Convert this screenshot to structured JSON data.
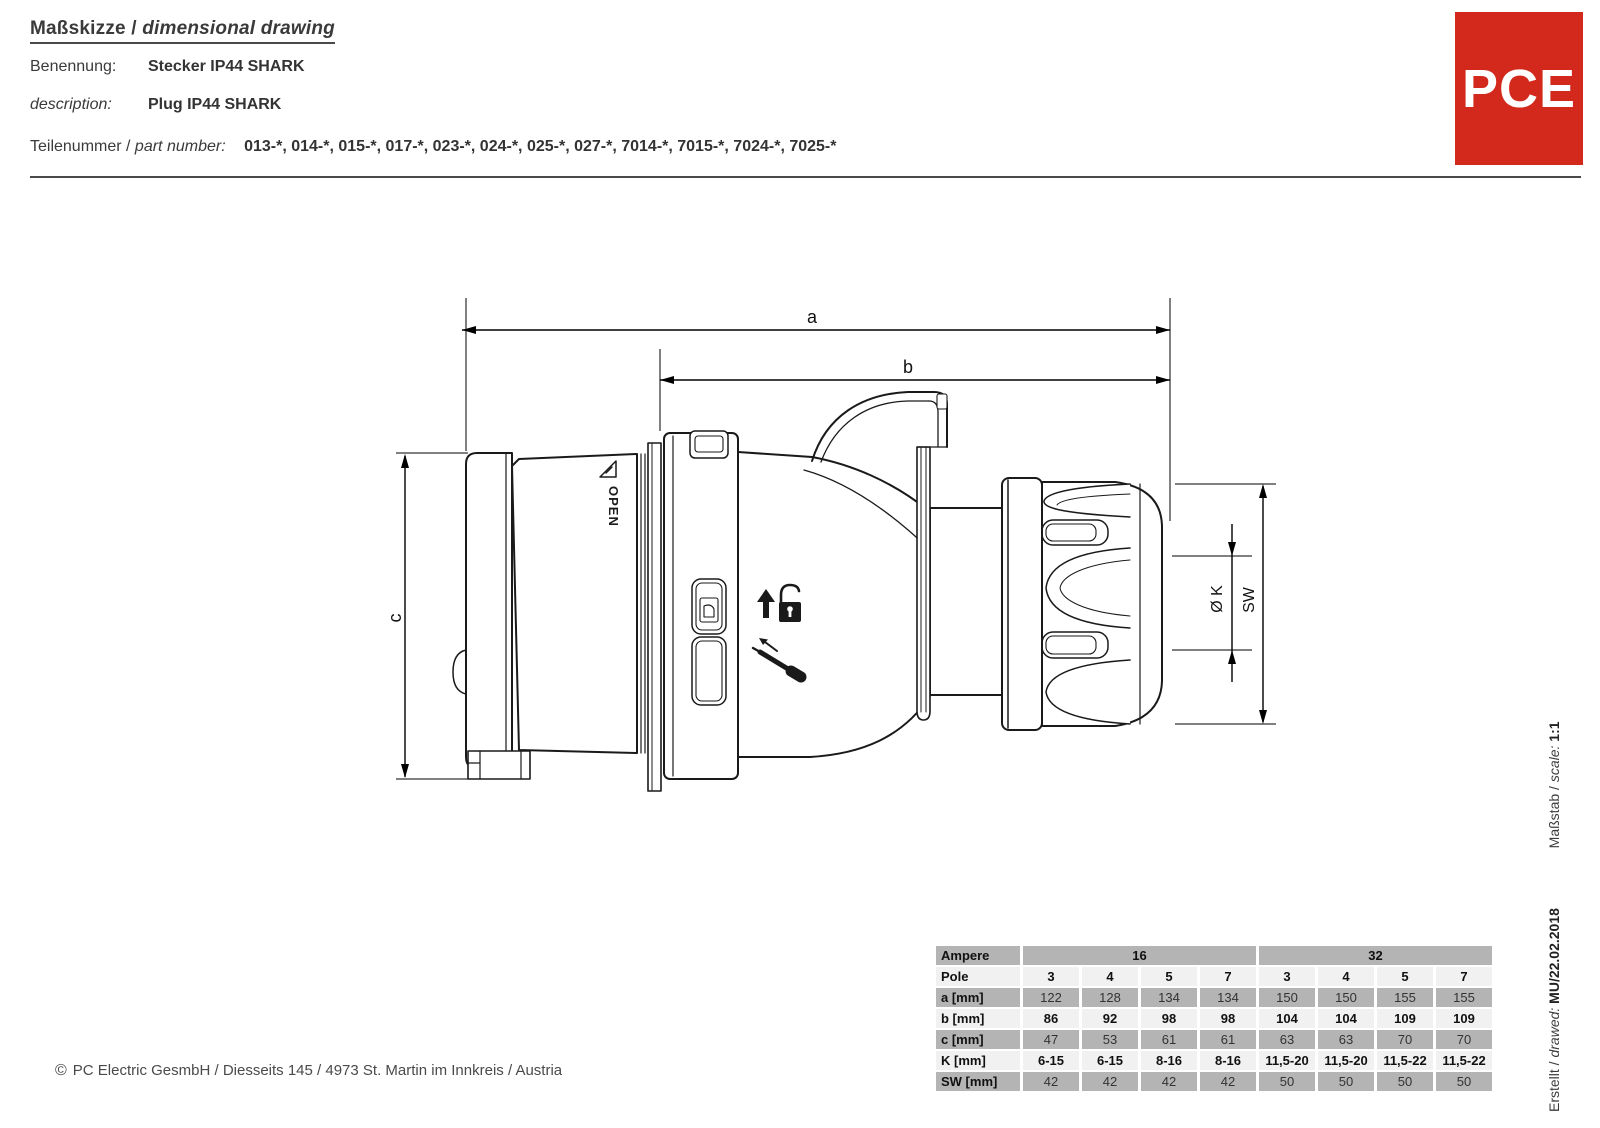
{
  "header": {
    "title_de": "Maßskizze",
    "title_separator": " / ",
    "title_en": "dimensional drawing",
    "benennung_label": "Benennung:",
    "benennung_value": "Stecker IP44 SHARK",
    "description_label": "description:",
    "description_value": "Plug IP44 SHARK",
    "teilenummer_label": "Teilenummer / ",
    "part_number_label": "part number:",
    "part_numbers": "013-*, 014-*, 015-*, 017-*, 023-*, 024-*, 025-*, 027-*, 7014-*, 7015-*, 7024-*, 7025-*"
  },
  "logo": {
    "text": "PCE",
    "color": "#d3291c"
  },
  "drawing": {
    "dim_a": "a",
    "dim_b": "b",
    "dim_c": "c",
    "dim_k": "Ø K",
    "dim_sw": "SW",
    "open_label": "OPEN"
  },
  "dimensions_table": {
    "ampere_label": "Ampere",
    "ampere_16": "16",
    "ampere_32": "32",
    "rows": [
      {
        "label": "Pole",
        "values": [
          "3",
          "4",
          "5",
          "7",
          "3",
          "4",
          "5",
          "7"
        ]
      },
      {
        "label": "a [mm]",
        "values": [
          "122",
          "128",
          "134",
          "134",
          "150",
          "150",
          "155",
          "155"
        ]
      },
      {
        "label": "b [mm]",
        "values": [
          "86",
          "92",
          "98",
          "98",
          "104",
          "104",
          "109",
          "109"
        ]
      },
      {
        "label": "c [mm]",
        "values": [
          "47",
          "53",
          "61",
          "61",
          "63",
          "63",
          "70",
          "70"
        ]
      },
      {
        "label": "K [mm]",
        "values": [
          "6-15",
          "6-15",
          "8-16",
          "8-16",
          "11,5-20",
          "11,5-20",
          "11,5-22",
          "11,5-22"
        ]
      },
      {
        "label": "SW [mm]",
        "values": [
          "42",
          "42",
          "42",
          "42",
          "50",
          "50",
          "50",
          "50"
        ]
      }
    ]
  },
  "footer": {
    "copyright": "©",
    "text": "PC Electric GesmbH / Diesseits 145 / 4973 St. Martin im Innkreis / Austria"
  },
  "side_info": {
    "erstellt_label": "Erstellt / ",
    "drawed_label": "drawed:",
    "drawed_value": "MU/22.02.2018",
    "massstab_label": "Maßstab / ",
    "scale_label": "scale:",
    "scale_value": "1:1"
  }
}
